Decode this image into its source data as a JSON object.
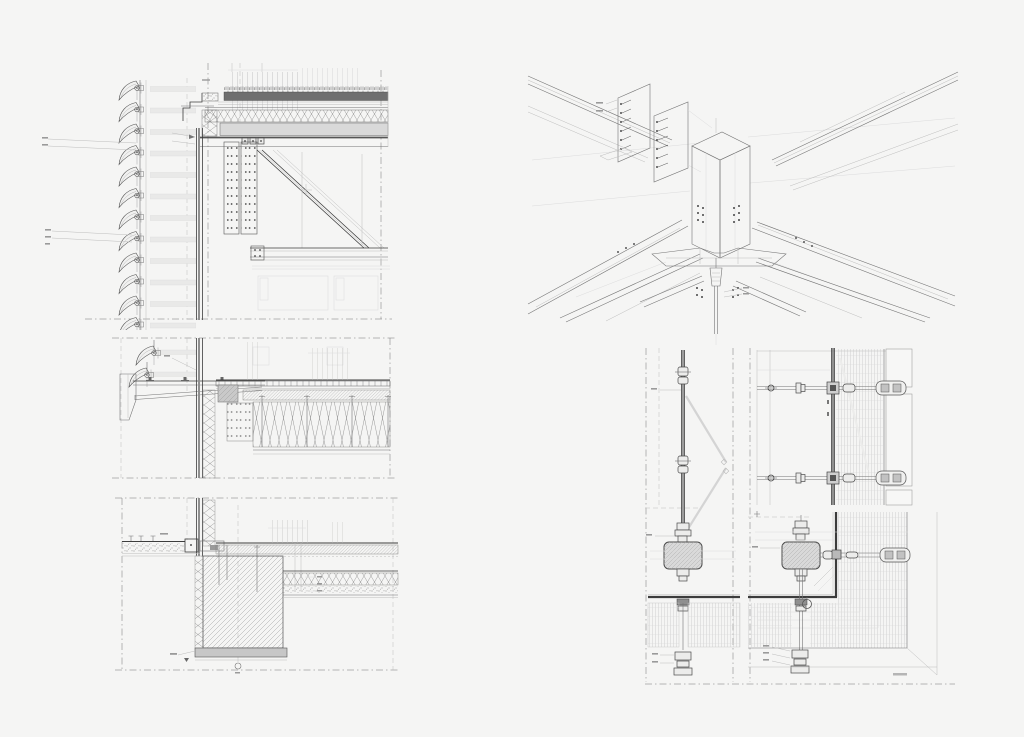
{
  "sheet": {
    "kind": "architectural-construction-detail-sheet",
    "style": "grayscale CAD line drawing, no legible text labels"
  },
  "colors": {
    "paper": "#f5f5f4",
    "line_dark": "#3d3d3d",
    "line_mid": "#757575",
    "line_faint": "#bdbdbd",
    "line_xfaint": "#dcdcdc",
    "hatch": "#9e9e9e",
    "fill_dark": "#6f6f6f",
    "fill_mid": "#c7c7c7",
    "fill_light": "#d9d9d9",
    "fill_bar": "#e9e9e8",
    "accent_thick": "#3c3c3c"
  },
  "panels": [
    {
      "id": "roof-parapet-section",
      "position": "top-left",
      "elements": [
        "louver-array",
        "green-roof-buildup",
        "rigid-insulation",
        "concrete-slab",
        "steel-truss-diagonal",
        "bolted-splice-plates",
        "suspended-ceiling"
      ]
    },
    {
      "id": "steel-node-axonometric",
      "position": "top-right",
      "elements": [
        "box-node",
        "radiating-i-beams",
        "bolted-end-plates",
        "winged-gusset-plate",
        "tension-rod-turnbuckle",
        "bolt-clusters"
      ]
    },
    {
      "id": "floor-edge-section",
      "position": "middle-left",
      "elements": [
        "louver-array",
        "maintenance-catwalk-bracket",
        "metal-deck",
        "screed",
        "batt-insulation-with-anchors",
        "perforated-panel"
      ]
    },
    {
      "id": "base-foundation-section",
      "position": "bottom-left",
      "elements": [
        "exterior-ground-stipple",
        "floor-screed",
        "foundation-wall-hatch",
        "footing",
        "lower-floor-slab",
        "axis-marker-circle"
      ]
    },
    {
      "id": "facade-plan-details",
      "position": "bottom-right",
      "elements": [
        "mullion-plan",
        "operable-vent-swing",
        "facade-column",
        "spider-arm-fittings",
        "corner-glazing",
        "spandrel-grid-hatch",
        "detail-circle-marker"
      ]
    }
  ]
}
